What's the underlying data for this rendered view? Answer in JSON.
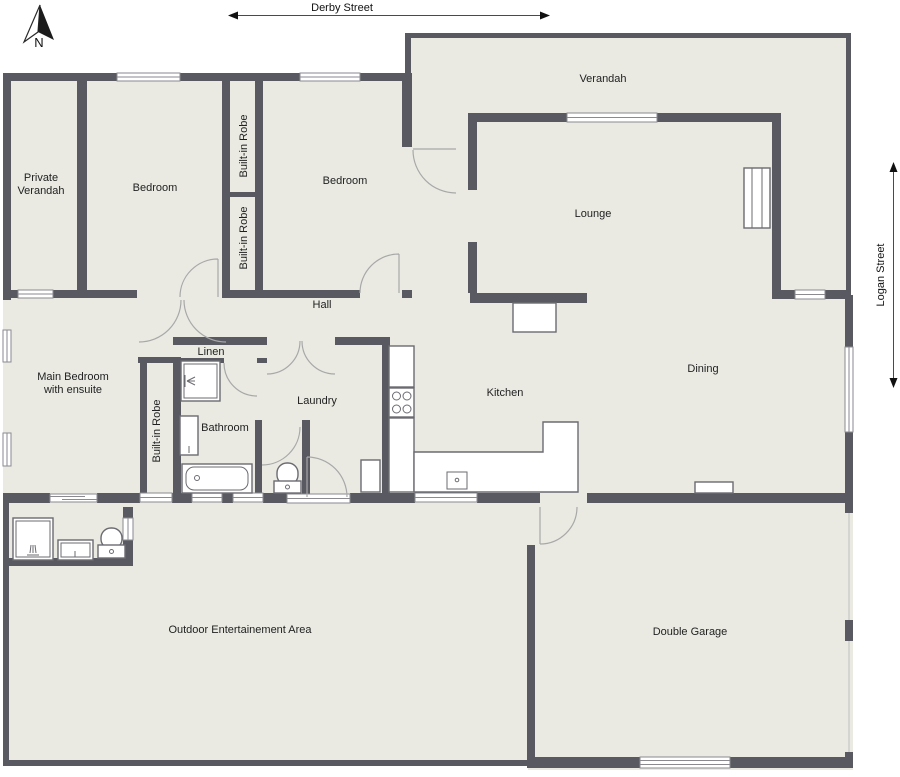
{
  "plan": {
    "north_label": "N",
    "streets": {
      "top": "Derby Street",
      "right": "Logan Street"
    },
    "rooms": {
      "private_verandah_line1": "Private",
      "private_verandah_line2": "Verandah",
      "bedroom_front": "Bedroom",
      "bedroom_middle": "Bedroom",
      "robe_upper": "Built-in Robe",
      "robe_lower": "Built-in Robe",
      "robe_main": "Built-in Robe",
      "verandah": "Verandah",
      "lounge": "Lounge",
      "hall": "Hall",
      "main_bedroom_line1": "Main Bedroom",
      "main_bedroom_line2": "with ensuite",
      "linen": "Linen",
      "bathroom": "Bathroom",
      "laundry": "Laundry",
      "kitchen": "Kitchen",
      "dining": "Dining",
      "outdoor": "Outdoor Entertainement Area",
      "garage": "Double Garage"
    },
    "colors": {
      "wall": "#595962",
      "floor": "#eaeae3",
      "window_stroke": "#8a8a90",
      "door_arc": "#a8a8a8",
      "text": "#1f1f1f",
      "background": "#ffffff"
    }
  }
}
